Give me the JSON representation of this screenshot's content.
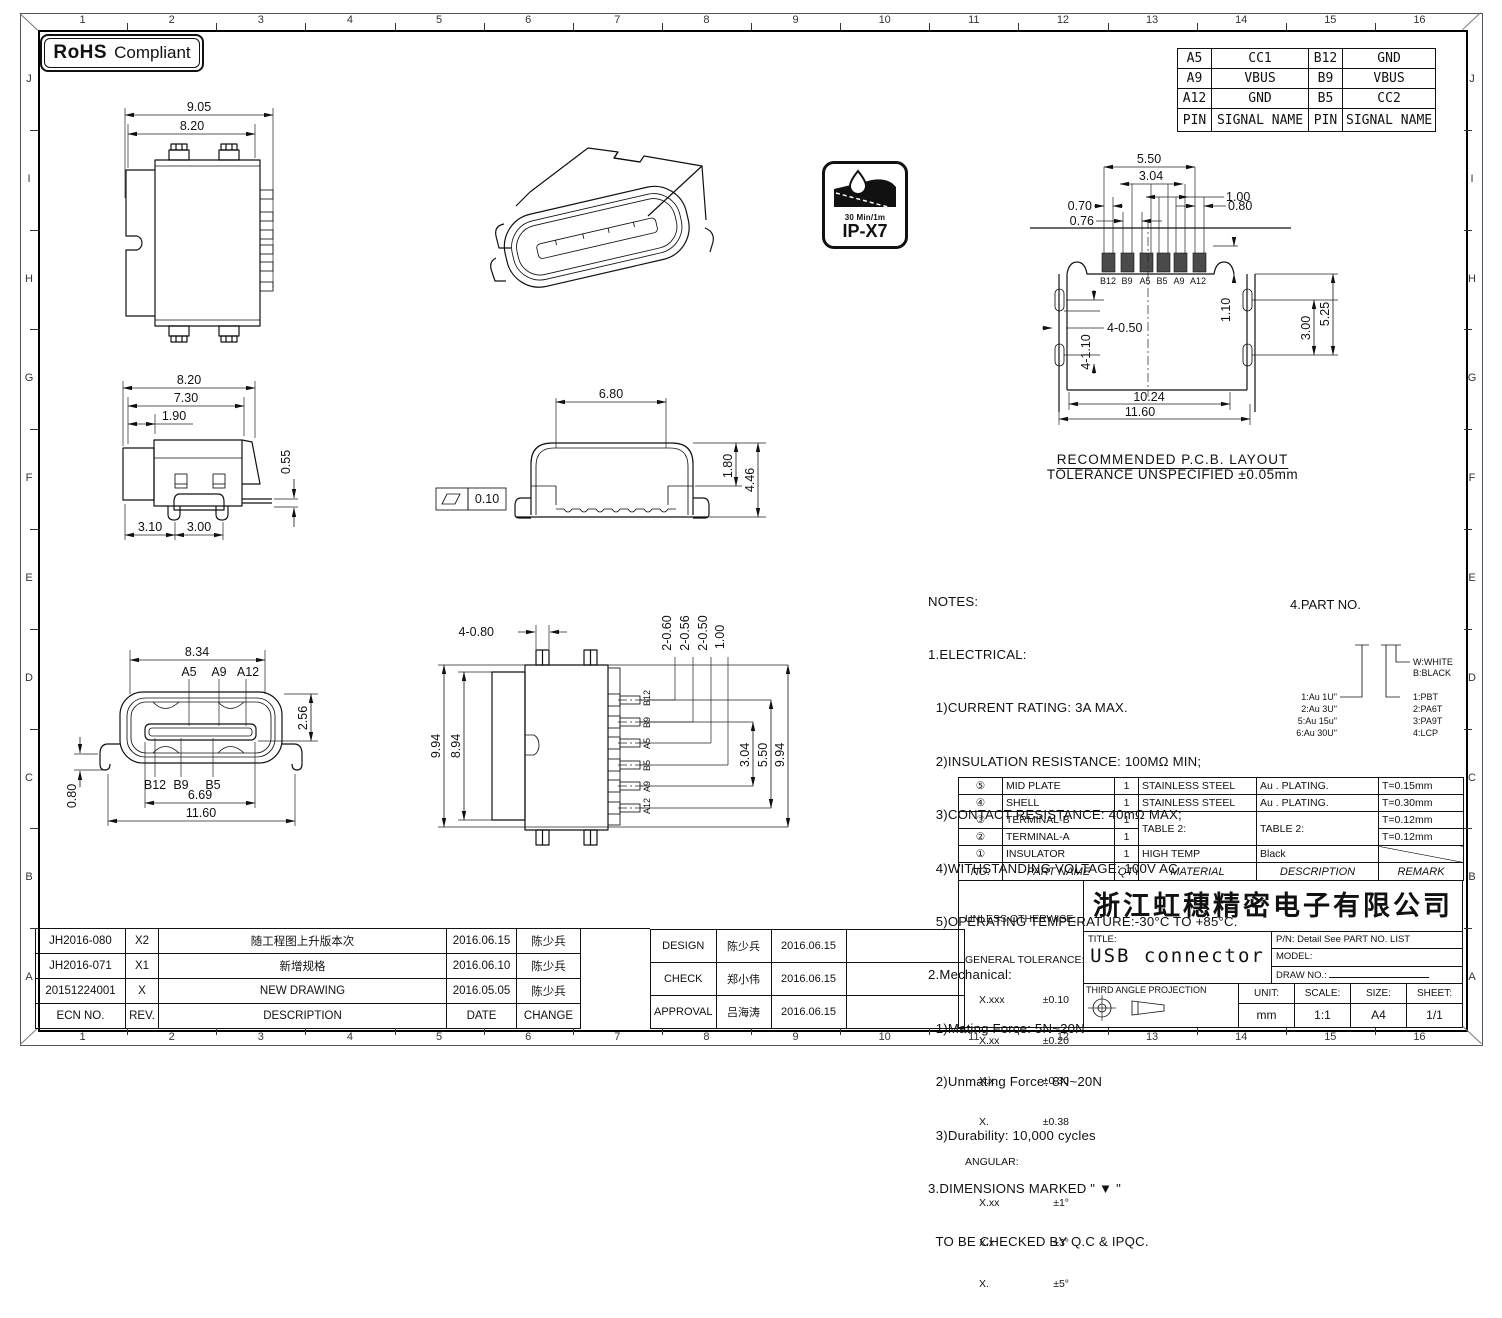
{
  "frame": {
    "zone_numbers": [
      "1",
      "2",
      "3",
      "4",
      "5",
      "6",
      "7",
      "8",
      "9",
      "10",
      "11",
      "12",
      "13",
      "14",
      "15",
      "16"
    ],
    "zone_letters": [
      "J",
      "I",
      "H",
      "G",
      "F",
      "E",
      "D",
      "C",
      "B",
      "A"
    ]
  },
  "badges": {
    "rohs_bold": "RoHS",
    "rohs_rest": "Compliant",
    "ip_line1": "30 Min/1m",
    "ip_line2": "IP-X7"
  },
  "pin_table": {
    "rows": [
      [
        "A5",
        "CC1",
        "B12",
        "GND"
      ],
      [
        "A9",
        "VBUS",
        "B9",
        "VBUS"
      ],
      [
        "A12",
        "GND",
        "B5",
        "CC2"
      ],
      [
        "PIN",
        "SIGNAL NAME",
        "PIN",
        "SIGNAL NAME"
      ]
    ]
  },
  "top_view": {
    "d1": "9.05",
    "d2": "8.20"
  },
  "side_view": {
    "d1": "8.20",
    "d2": "7.30",
    "d3": "1.90",
    "d4": "0.55",
    "d5": "3.10",
    "d6": "3.00"
  },
  "front_section": {
    "d1": "6.80",
    "d2": "1.80",
    "d3": "4.46",
    "flatness": "0.10"
  },
  "front_view": {
    "d1": "8.34",
    "d2": "2.56",
    "d3": "0.80",
    "d4": "6.69",
    "d5": "11.60",
    "pa": [
      "A5",
      "A9",
      "A12"
    ],
    "pb": [
      "B12",
      "B9",
      "B5"
    ]
  },
  "bottom_view": {
    "d1": "4-0.80",
    "d2": "9.94",
    "d3": "8.94",
    "d4": "2-0.60",
    "d5": "2-0.56",
    "d6": "2-0.50",
    "d7": "1.00",
    "d8": "3.04",
    "d9": "5.50",
    "d10": "9.94",
    "pins": [
      "B12",
      "B9",
      "A5",
      "B5",
      "A9",
      "A12"
    ]
  },
  "pcb": {
    "d1": "5.50",
    "d2": "3.04",
    "d3": "1.00",
    "d4": "0.70",
    "d5": "0.80",
    "d6": "0.76",
    "d7": "1.10",
    "d8": "4-0.50",
    "d9": "4-1.10",
    "d10": "3.00",
    "d11": "5.25",
    "d12": "10.24",
    "d13": "11.60",
    "pins": [
      "B12",
      "B9",
      "A5",
      "B5",
      "A9",
      "A12"
    ],
    "title": "RECOMMENDED  P.C.B. LAYOUT",
    "subtitle": "TOLERANCE UNSPECIFIED ±0.05mm"
  },
  "notes": {
    "lines": [
      "NOTES:",
      "1.ELECTRICAL:",
      "  1)CURRENT RATING: 3A MAX.",
      "  2)INSULATION RESISTANCE: 100MΩ MIN;",
      "  3)CONTACT RESISTANCE: 40mΩ MAX;",
      "  4)WITHSTANDING VOLTAGE: 100V AC",
      "  5)OPERATING TEMPERATURE:-30°C TO +85°C.",
      "2.Mechanical:",
      "  1)Mating Force: 5N~20N",
      "  2)Unmating Force: 8N~20N",
      "  3)Durability: 10,000 cycles",
      "3.DIMENSIONS MARKED \" ▼ \"",
      "  TO BE CHECKED BY Q.C & IPQC."
    ]
  },
  "part_no": {
    "title": "4.PART NO.",
    "plating": [
      "1:Au 1U\"",
      "2:Au 3U\"",
      "5:Au 15u\"",
      "6:Au 30U\""
    ],
    "shell_colors": [
      "W:WHITE",
      "B:BLACK"
    ],
    "materials": [
      "1:PBT",
      "2:PA6T",
      "3:PA9T",
      "4:LCP"
    ]
  },
  "bom": {
    "rows": [
      {
        "no": "⑤",
        "part": "MID PLATE",
        "qty": "1",
        "mat": "STAINLESS STEEL",
        "desc": "Au . PLATING.",
        "rem": "T=0.15mm"
      },
      {
        "no": "④",
        "part": "SHELL",
        "qty": "1",
        "mat": "STAINLESS STEEL",
        "desc": "Au . PLATING.",
        "rem": "T=0.30mm"
      },
      {
        "no": "③",
        "part": "TERMINAL-B",
        "qty": "1",
        "mat": "TABLE 2:",
        "desc": "TABLE 2:",
        "rem": "T=0.12mm"
      },
      {
        "no": "②",
        "part": "TERMINAL-A",
        "qty": "1",
        "rem": "T=0.12mm"
      },
      {
        "no": "①",
        "part": "INSULATOR",
        "qty": "1",
        "mat": "HIGH TEMP",
        "desc": "Black",
        "rem": ""
      }
    ],
    "headers": {
      "no": "NO.",
      "part": "PART NAME",
      "qty": "QTY",
      "mat": "MATERIAL",
      "desc": "DESCRIPTION",
      "rem": "REMARK"
    }
  },
  "tolerance": {
    "h1": "UNLESS OTHERWISE,",
    "h2": "GENERAL TOLERANCE:",
    "rows": [
      [
        "X.xxx",
        "±0.10"
      ],
      [
        "X.xx",
        "±0.20"
      ],
      [
        "X.x",
        "±0.30"
      ],
      [
        "X.",
        "±0.38"
      ]
    ],
    "angular_label": "ANGULAR:",
    "angular_rows": [
      [
        "X.xx",
        "±1°"
      ],
      [
        "X.x",
        "±3°"
      ],
      [
        "X.",
        "±5°"
      ]
    ]
  },
  "title_block": {
    "company": "浙江虹穗精密电子有限公司",
    "title_label": "TITLE:",
    "title": "USB connector",
    "pn": "P/N: Detail See PART NO. LIST",
    "model_label": "MODEL:",
    "draw_label": "DRAW NO.:",
    "projection": "THIRD ANGLE PROJECTION",
    "unit_label": "UNIT:",
    "unit": "mm",
    "scale_label": "SCALE:",
    "scale": "1:1",
    "size_label": "SIZE:",
    "size": "A4",
    "sheet_label": "SHEET:",
    "sheet": "1/1"
  },
  "revisions": {
    "rows": [
      [
        "JH2016-080",
        "X2",
        "随工程图上升版本次",
        "2016.06.15",
        "陈少兵"
      ],
      [
        "JH2016-071",
        "X1",
        "新增规格",
        "2016.06.10",
        "陈少兵"
      ],
      [
        "20151224001",
        "X",
        "NEW DRAWING",
        "2016.05.05",
        "陈少兵"
      ],
      [
        "ECN NO.",
        "REV.",
        "DESCRIPTION",
        "DATE",
        "CHANGE"
      ]
    ]
  },
  "approvals": {
    "rows": [
      [
        "DESIGN",
        "陈少兵",
        "2016.06.15"
      ],
      [
        "CHECK",
        "郑小伟",
        "2016.06.15"
      ],
      [
        "APPROVAL",
        "吕海涛",
        "2016.06.15"
      ]
    ]
  }
}
